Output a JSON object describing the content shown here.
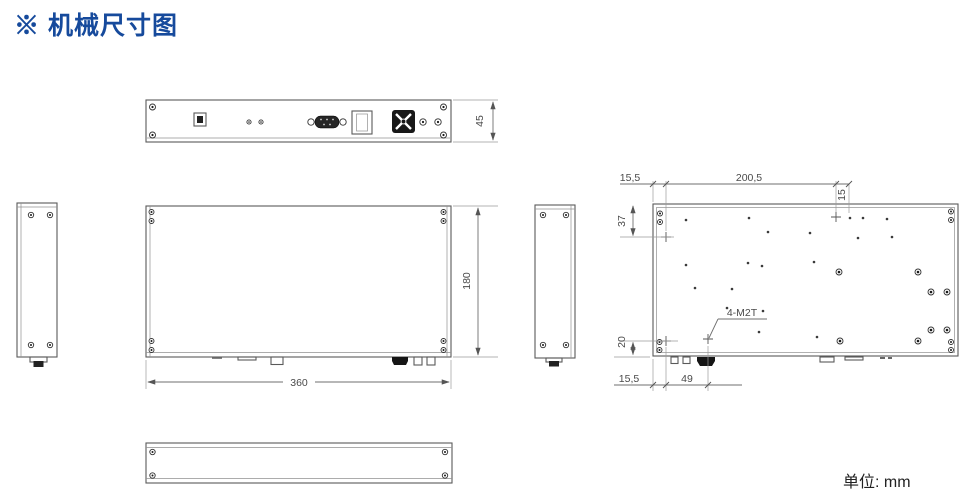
{
  "title": "※ 机械尺寸图",
  "unit_label": "单位: mm",
  "colors": {
    "title": "#164a9c",
    "object_line": "#5a5a5a",
    "dim_text": "#4a4a4a"
  },
  "drawing": {
    "rear_panel_view": {
      "height": "45"
    },
    "front_view": {
      "width": "360",
      "height": "180"
    },
    "bottom_view": {
      "top_left_offset": "15,5",
      "top_span": "200,5",
      "top_right_offset": "15",
      "side_top": "37",
      "side_bottom": "20",
      "bottom_left_offset": "15,5",
      "bottom_span": "49",
      "thread_callout": "4-M2T"
    }
  }
}
